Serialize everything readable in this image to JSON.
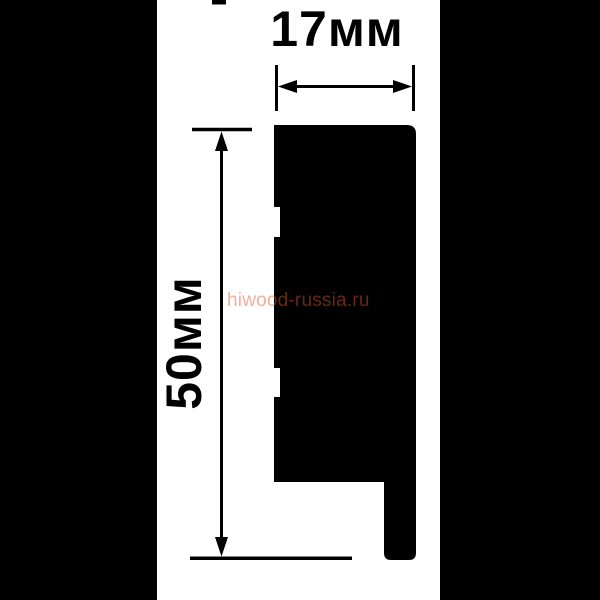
{
  "diagram": {
    "type": "profile-cross-section",
    "width_label": "17мм",
    "height_label": "50мм",
    "width_mm": 17,
    "height_mm": 50
  },
  "watermark": {
    "text": "hiwood-russia.ru",
    "color": "#dc5523"
  },
  "colors": {
    "background": "#ffffff",
    "ink": "#000000",
    "letterbox": "#000000",
    "profile": "#000000"
  },
  "icons": {
    "arrow_left": "left-pointing dimension arrowhead",
    "arrow_right": "right-pointing dimension arrowhead",
    "arrow_up": "up-pointing dimension arrowhead",
    "arrow_down": "down-pointing dimension arrowhead"
  }
}
